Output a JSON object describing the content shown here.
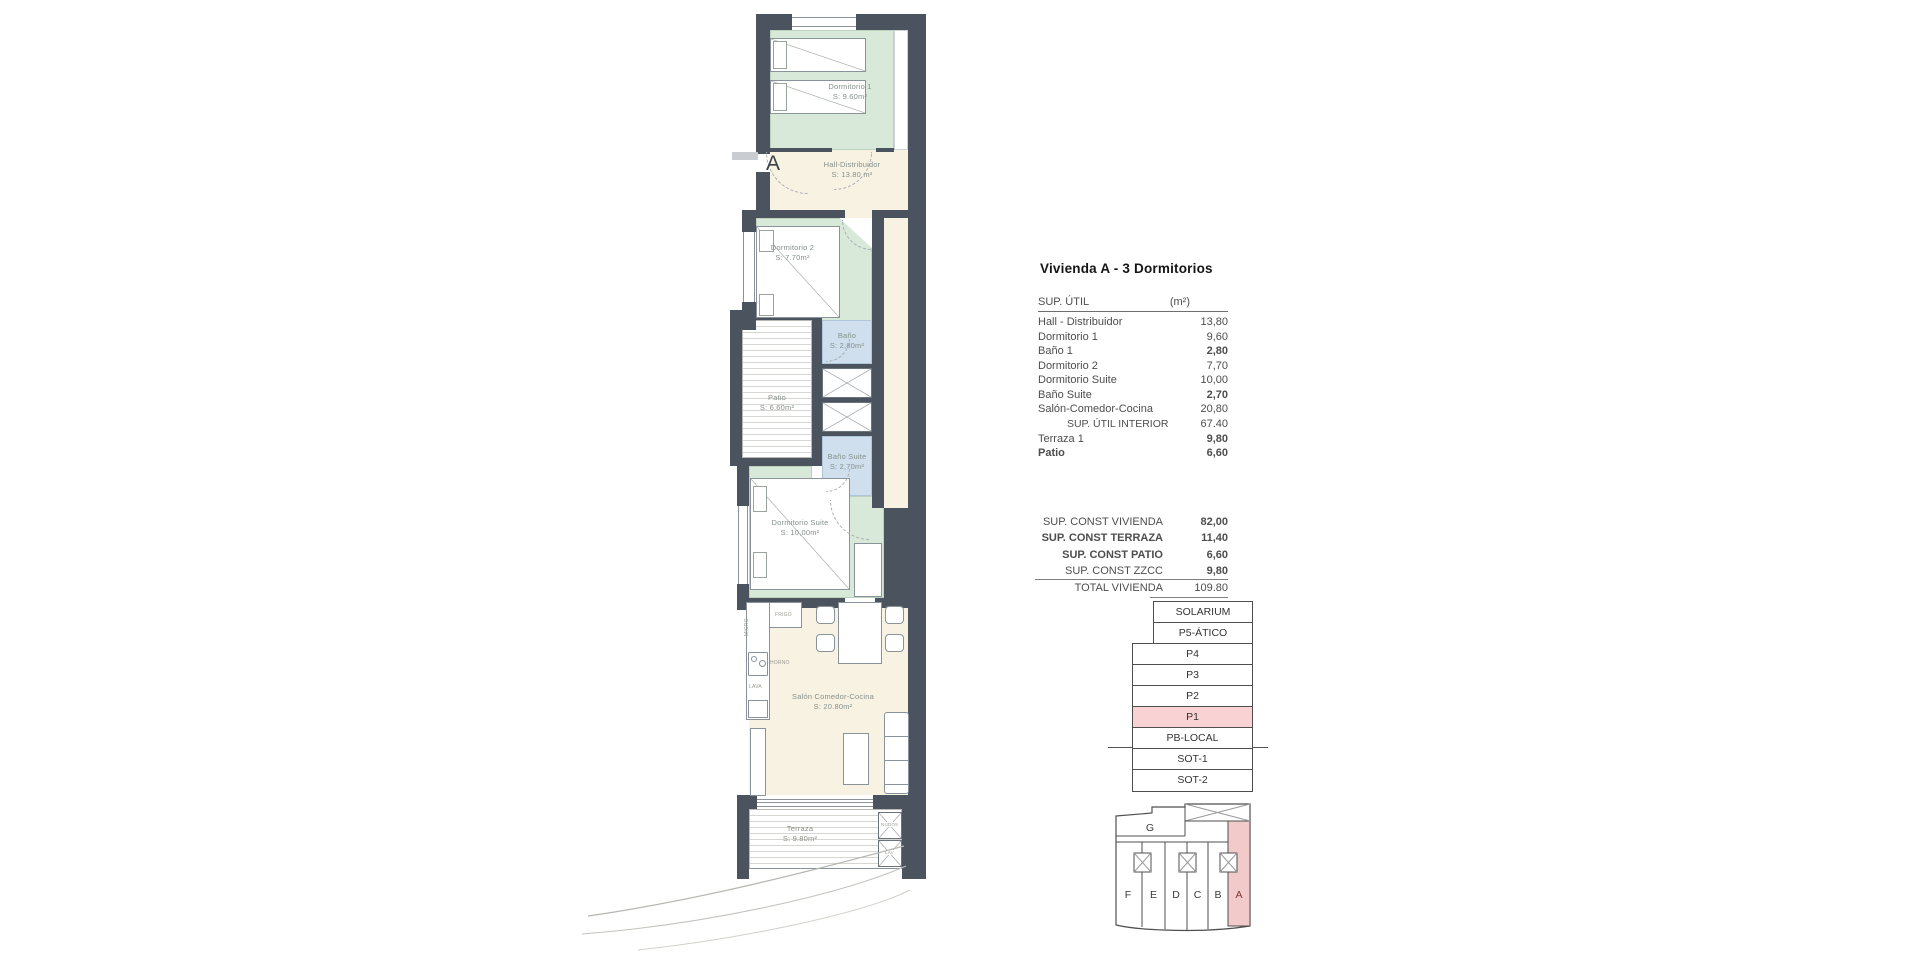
{
  "plan": {
    "entrance_label": "A",
    "rooms": {
      "dorm1": {
        "name": "Dormitorio 1",
        "area": "S: 9.60m²"
      },
      "hall": {
        "name": "Hall-Distribuidor",
        "area": "S: 13.80 m²"
      },
      "dorm2": {
        "name": "Dormitorio 2",
        "area": "S: 7.70m²"
      },
      "bano": {
        "name": "Baño",
        "area": "S: 2,80m²"
      },
      "patio": {
        "name": "Patio",
        "area": "S: 6.60m²"
      },
      "bano_suite": {
        "name": "Baño Suite",
        "area": "S: 2,70m²"
      },
      "suite": {
        "name": "Dormitorio Suite",
        "area": "S: 10,00m²"
      },
      "salon": {
        "name": "Salón Comedor-Cocina",
        "area": "S: 20.80m²"
      },
      "terraza": {
        "name": "Terraza",
        "area": "S: 9.80m²"
      }
    },
    "kitchen": {
      "frigo": "FRIGO",
      "micro": "MICRO",
      "horno": "HORNO",
      "lava": "LAVA"
    },
    "terrace_boxes": {
      "top": "NUDOS",
      "bottom": "LAV"
    }
  },
  "panel": {
    "title": "Vivienda A - 3 Dormitorios",
    "sup_util": {
      "header_label": "SUP. ÚTIL",
      "header_unit": "(m²)",
      "rows": [
        {
          "label": "Hall - Distribuidor",
          "value": "13,80"
        },
        {
          "label": "Dormitorio 1",
          "value": "9,60"
        },
        {
          "label": "Baño 1",
          "value": "2,80"
        },
        {
          "label": "Dormitorio 2",
          "value": "7,70"
        },
        {
          "label": "Dormitorio Suite",
          "value": "10,00"
        },
        {
          "label": "Baño Suite",
          "value": "2,70"
        },
        {
          "label": "Salón-Comedor-Cocina",
          "value": "20,80"
        },
        {
          "label": "SUP. ÚTIL INTERIOR",
          "value": "67.40"
        },
        {
          "label": "Terraza 1",
          "value": "9,80"
        },
        {
          "label": "Patio",
          "value": "6,60"
        }
      ]
    },
    "totals": [
      {
        "label": "SUP. CONST VIVIENDA",
        "value": "82,00"
      },
      {
        "label": "SUP. CONST TERRAZA",
        "value": "11,40"
      },
      {
        "label": "SUP. CONST PATIO",
        "value": "6,60"
      },
      {
        "label": "SUP. CONST ZZCC",
        "value": "9,80"
      },
      {
        "label": "TOTAL VIVIENDA",
        "value": "109.80"
      }
    ],
    "levels": [
      {
        "label": "SOLARIUM"
      },
      {
        "label": "P5-ÁTICO"
      },
      {
        "label": "P4"
      },
      {
        "label": "P3"
      },
      {
        "label": "P2"
      },
      {
        "label": "P1"
      },
      {
        "label": "PB-LOCAL"
      },
      {
        "label": "SOT-1"
      },
      {
        "label": "SOT-2"
      }
    ],
    "footprint": {
      "block_label": "G",
      "units": [
        "F",
        "E",
        "D",
        "C",
        "B",
        "A"
      ],
      "highlighted_unit": "A"
    },
    "colors": {
      "wall": "#4b545e",
      "room_green": "#d9e9d9",
      "room_blue": "#cfdfee",
      "floor_cream": "#f8f2e3",
      "highlight_pink": "#f9d3d3",
      "footprint_pink": "#f3caca"
    }
  }
}
